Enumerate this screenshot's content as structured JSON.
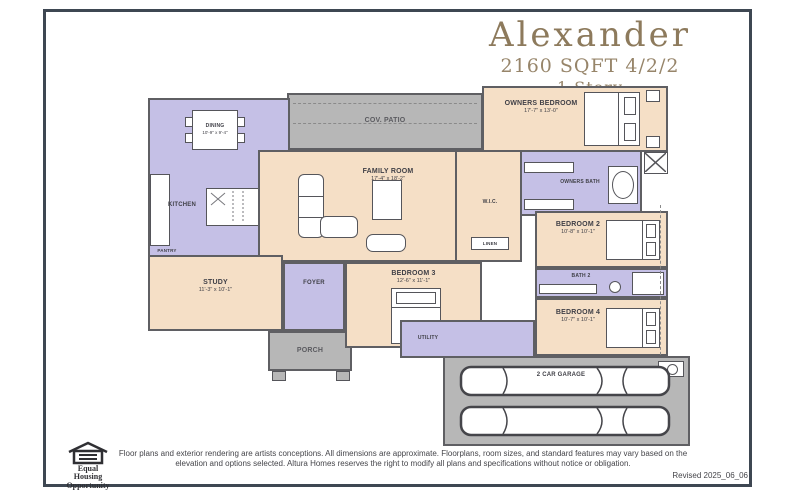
{
  "header": {
    "title": "Alexander",
    "subtitle": "2160 SQFT 4/2/2",
    "story": "1 Story",
    "accent_color": "#8d7a5c"
  },
  "plan": {
    "colors": {
      "room_peach": "#f5dfc6",
      "room_purple": "#c5c0e6",
      "outdoor_gray": "#b7b7b7",
      "wall": "#5f5f63",
      "frame": "#3e4752"
    },
    "rooms": {
      "cov_patio": {
        "label": "COV. PATIO"
      },
      "owners_bedroom": {
        "label": "OWNERS BEDROOM",
        "dims": "17'-7\" x 13'-0\""
      },
      "owners_bath": {
        "label": "OWNERS BATH"
      },
      "dining": {
        "label": "DINING",
        "dims": "10'-9\" x 9'-4\""
      },
      "kitchen": {
        "label": "KITCHEN"
      },
      "pantry": {
        "label": "PANTRY"
      },
      "family_room": {
        "label": "FAMILY ROOM",
        "dims": "17'-4\" x 18'-2\""
      },
      "wic": {
        "label": "W.I.C."
      },
      "linen": {
        "label": "LINEN"
      },
      "study": {
        "label": "STUDY",
        "dims": "11'-3\" x 10'-1\""
      },
      "foyer": {
        "label": "FOYER"
      },
      "porch": {
        "label": "PORCH"
      },
      "bedroom3": {
        "label": "BEDROOM 3",
        "dims": "12'-6\" x 11'-1\""
      },
      "utility": {
        "label": "UTILITY"
      },
      "bedroom2": {
        "label": "BEDROOM 2",
        "dims": "10'-8\" x 10'-1\""
      },
      "bath2": {
        "label": "BATH 2"
      },
      "bedroom4": {
        "label": "BEDROOM 4",
        "dims": "10'-7\" x 10'-1\""
      },
      "garage": {
        "label": "2 CAR GARAGE"
      }
    }
  },
  "footer": {
    "equal_housing": {
      "line1": "Equal",
      "line2": "Housing",
      "line3": "Opportunity"
    },
    "disclaimer": "Floor plans and exterior rendering are artists conceptions. All dimensions are approximate. Floorplans, room sizes, and standard features may vary based on the elevation and options selected. Altura Homes reserves the right to modify all plans and specifications without notice or obligation.",
    "revised": "Revised 2025_06_06"
  }
}
